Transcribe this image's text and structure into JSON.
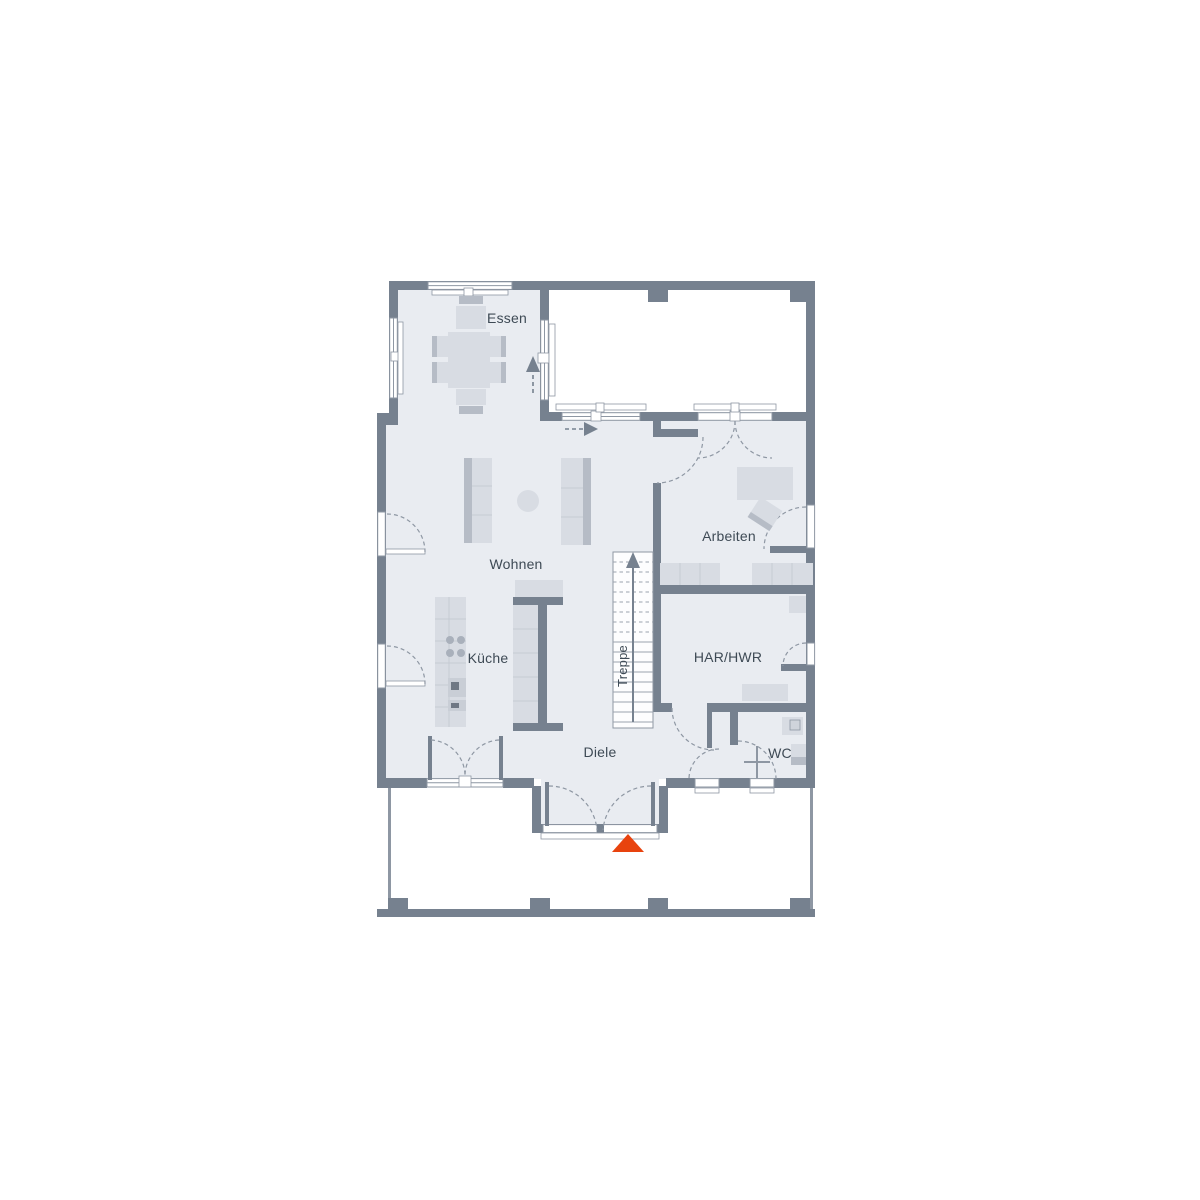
{
  "colors": {
    "wall": "#76818f",
    "floor": "#e9ecf1",
    "furn": "#d8dce3",
    "furnd": "#b6bcc6",
    "line": "#8e97a3",
    "divider": "#c6cbd3",
    "stair": "#9aa2ae",
    "text": "#3e4a55",
    "accent": "#e8430e",
    "appliance_dark": "#6f7884"
  },
  "labels": {
    "essen": "Essen",
    "wohnen": "Wohnen",
    "kueche": "Küche",
    "treppe": "Treppe",
    "diele": "Diele",
    "arbeiten": "Arbeiten",
    "har_hwr": "HAR/HWR",
    "wc": "WC"
  },
  "icons": {
    "entrance_arrow": "red-triangle-up",
    "walk_direction_essen": "dashed-arrow-up",
    "walk_direction_terrace": "dashed-arrow-right",
    "stair_direction": "arrow-up"
  }
}
